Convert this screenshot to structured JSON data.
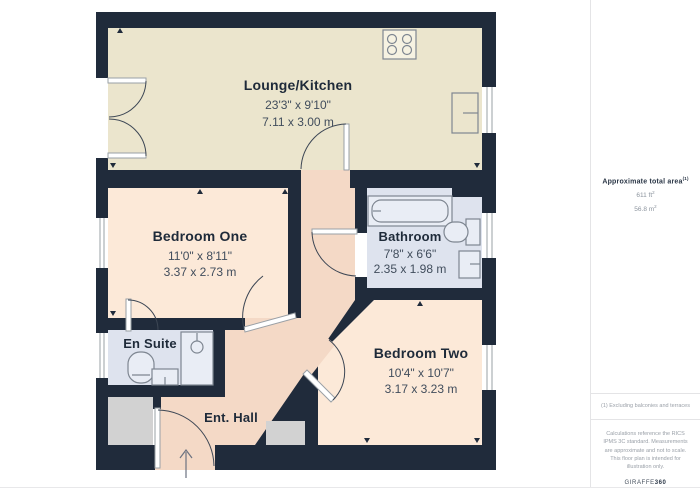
{
  "plan": {
    "rooms": [
      {
        "id": "lounge-kitchen",
        "name": "Lounge/Kitchen",
        "dims_imperial": "23'3\" x 9'10\"",
        "dims_metric": "7.11 x 3.00 m"
      },
      {
        "id": "bedroom-one",
        "name": "Bedroom One",
        "dims_imperial": "11'0\" x 8'11\"",
        "dims_metric": "3.37 x 2.73 m"
      },
      {
        "id": "bathroom",
        "name": "Bathroom",
        "dims_imperial": "7'8\" x 6'6\"",
        "dims_metric": "2.35 x 1.98 m"
      },
      {
        "id": "en-suite",
        "name": "En Suite"
      },
      {
        "id": "bedroom-two",
        "name": "Bedroom Two",
        "dims_imperial": "10'4\" x 10'7\"",
        "dims_metric": "3.17 x 3.23 m"
      },
      {
        "id": "ent-hall",
        "name": "Ent. Hall"
      }
    ],
    "fixture_icons": [
      "hob-icon",
      "bathtub-icon",
      "toilet-icon",
      "sink-icon",
      "shower-icon",
      "window-icon",
      "door-swing-icon",
      "entrance-arrow-icon"
    ]
  },
  "sidebar": {
    "area_title": "Approximate total area",
    "area_title_sup": "(1)",
    "area_imperial": "611 ft",
    "area_imperial_sup": "2",
    "area_metric": "56.8 m",
    "area_metric_sup": "2",
    "footnote": "(1) Excluding balconies and terraces",
    "disclaimer": "Calculations reference the RICS IPMS 3C standard. Measurements are approximate and not to scale. This floor plan is intended for illustration only.",
    "brand_name": "GIRAFFE",
    "brand_suffix": "360"
  },
  "colors": {
    "wall": "#202B3B",
    "lounge": "#EBE5CD",
    "bedroom": "#FCE9D8",
    "hall": "#F4D9C6",
    "bathroom": "#DEE3EE",
    "outside": "#D2D2D2",
    "fixture_fill": "#E9EDF5",
    "hob_fill": "#F6F2E2",
    "text_dark": "#1E2A39",
    "text_dim": "#414D5C"
  }
}
